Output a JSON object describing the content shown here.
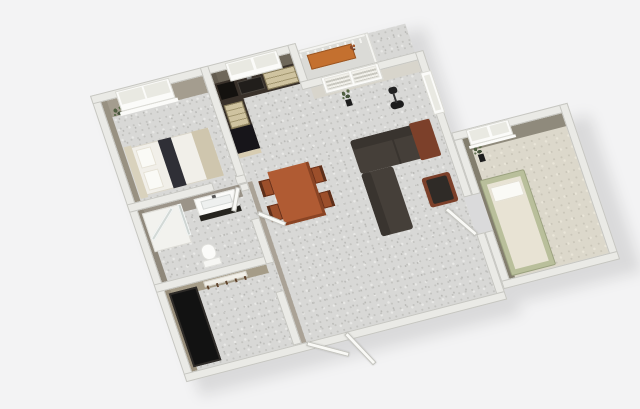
{
  "scene": {
    "title": "3D apartment floor plan render",
    "background": "#f3f3f4",
    "plan_matrix": "matrix(0.93,-0.24,0.31,0.92,90,96)",
    "shadow_matrix": "matrix(0.93,-0.24,0.31,0.92,104,110)",
    "shadow_color": "rgba(0,0,0,0.10)"
  },
  "palette": {
    "wall": "#eaeae6",
    "floor": "#d8d8d6",
    "bed1Wall": "#a49d8f",
    "bed1WallDk": "#989182",
    "kitchenWall": "#6e675a",
    "kitchenWallDk": "#645d51",
    "livingWall": "#d8d5cc",
    "bathWall": "#9b9489",
    "bathWallDk": "#8f887b",
    "entryWall": "#a59c88",
    "entryWallDk": "#998f7c",
    "bed2Wall": "#8f8a7c",
    "bed2WallDk": "#837e6e",
    "corridorWall": "#aaa296",
    "counterTop": "#39312a",
    "applianceBlack": "#17151a",
    "cooktop": "#14120f",
    "woodCab": "#cfc3a0",
    "cabEnd": "#d8cdb2",
    "sinkDark": "#211e1b",
    "metal": "#8a8a88",
    "sofa": "#453f39",
    "sofaDark": "#39342f",
    "rust": "#7c402a",
    "chairWood": "#9c4f2b",
    "chairDark": "#5d2f1a",
    "table": "#b05b33",
    "tableEdge": "#8a4424",
    "bedSheet": "#f1efe9",
    "headboard": "#d9d2bd",
    "pillow": "#fafaf6",
    "runner": "#2f2f36",
    "footBlanket": "#cfc6ae",
    "white": "#fbfbf9",
    "paneGlass": "#e9e9e2",
    "vanityBase": "#26241f",
    "wardrobe": "#121212",
    "bed2Frame": "#b9bf9b",
    "mattress": "#e8e3d4",
    "bench": "#c4702f",
    "lamp": "#1c1c1c",
    "pot": "#1d1d1d"
  },
  "rooms": [
    "bedroom-1",
    "kitchen",
    "living-room",
    "dining-area",
    "bathroom",
    "entry-hall",
    "bedroom-2",
    "balcony"
  ],
  "elements": [
    {
      "layer": "shadow",
      "name": "building-shadow-main",
      "x": 0,
      "y": 0,
      "w": 345,
      "h": 311,
      "fill": "rgba(0,0,0,0.10)"
    },
    {
      "layer": "shadow",
      "name": "building-shadow-bedroom2",
      "x": 345,
      "y": 130,
      "w": 134,
      "h": 170,
      "fill": "rgba(0,0,0,0.10)"
    },
    {
      "name": "main-floor",
      "x": 9,
      "y": 9,
      "w": 327,
      "h": 293,
      "cls": "floor-speckle"
    },
    {
      "name": "bedroom2-floor",
      "x": 354,
      "y": 139,
      "w": 107,
      "h": 152,
      "cls": "floor-beige"
    },
    {
      "name": "balcony-floor",
      "x": 221,
      "y": 10,
      "w": 75,
      "h": 30,
      "fill": "#dbdbd7"
    },
    {
      "name": "bedroom1-wall-face-top",
      "x": 9,
      "y": 9,
      "w": 109,
      "h": 18,
      "fill": "bed1Wall"
    },
    {
      "name": "bedroom1-wall-face-left",
      "x": 9,
      "y": 9,
      "w": 6,
      "h": 109,
      "fill": "bed1WallDk"
    },
    {
      "name": "kitchen-wall-face-top",
      "x": 127,
      "y": 9,
      "w": 85,
      "h": 20,
      "fill": "kitchenWall"
    },
    {
      "name": "kitchen-wall-face-left",
      "x": 127,
      "y": 9,
      "w": 5,
      "h": 89,
      "fill": "kitchenWallDk"
    },
    {
      "name": "living-wall-face-top",
      "x": 221,
      "y": 49,
      "w": 115,
      "h": 12,
      "fill": "livingWall"
    },
    {
      "name": "bathroom-wall-face-top",
      "x": 9,
      "y": 127,
      "w": 109,
      "h": 13,
      "fill": "bathWall"
    },
    {
      "name": "bathroom-wall-face-left",
      "x": 9,
      "y": 127,
      "w": 6,
      "h": 78,
      "fill": "bathWallDk"
    },
    {
      "name": "entry-wall-face-top",
      "x": 9,
      "y": 214,
      "w": 109,
      "h": 9,
      "fill": "entryWall"
    },
    {
      "name": "entry-wall-face-left",
      "x": 9,
      "y": 214,
      "w": 6,
      "h": 88,
      "fill": "entryWallDk"
    },
    {
      "name": "corridor-wall-face",
      "x": 127,
      "y": 127,
      "w": 5,
      "h": 175,
      "fill": "corridorWall"
    },
    {
      "name": "bedroom2-wall-face-top",
      "x": 354,
      "y": 139,
      "w": 107,
      "h": 14,
      "fill": "bed2Wall"
    },
    {
      "name": "bedroom2-wall-face-left",
      "x": 354,
      "y": 139,
      "w": 6,
      "h": 152,
      "fill": "bed2WallDk"
    },
    {
      "name": "bed-double-base",
      "x": 20,
      "y": 62,
      "w": 86,
      "h": 52,
      "fill": "bedSheet",
      "border": "1px solid #d8d4c8"
    },
    {
      "name": "bed-double-headboard",
      "x": 16,
      "y": 60,
      "w": 8,
      "h": 56,
      "fill": "headboard"
    },
    {
      "name": "bed-double-pillow-top",
      "x": 27,
      "y": 66,
      "w": 16,
      "h": 20,
      "fill": "pillow",
      "border": "1px solid #e5e1d5"
    },
    {
      "name": "bed-double-pillow-bottom",
      "x": 27,
      "y": 90,
      "w": 16,
      "h": 20,
      "fill": "pillow",
      "border": "1px solid #e5e1d5"
    },
    {
      "name": "bed-double-runner",
      "x": 52,
      "y": 62,
      "w": 14,
      "h": 52,
      "fill": "runner"
    },
    {
      "name": "bed-double-foot-blanket",
      "x": 88,
      "y": 62,
      "w": 18,
      "h": 52,
      "fill": "footBlanket"
    },
    {
      "name": "bedroom1-plant",
      "x": 14,
      "y": 14,
      "w": 18,
      "h": 16,
      "cls": "plant"
    },
    {
      "name": "kitchen-counter-top-leg",
      "x": 127,
      "y": 20,
      "w": 85,
      "h": 22,
      "fill": "counterTop"
    },
    {
      "name": "kitchen-counter-left-leg",
      "x": 127,
      "y": 20,
      "w": 24,
      "h": 76,
      "fill": "counterTop"
    },
    {
      "name": "kitchen-cooktop",
      "x": 129,
      "y": 22,
      "w": 18,
      "h": 16,
      "fill": "cooktop"
    },
    {
      "name": "kitchen-sink",
      "x": 150,
      "y": 24,
      "w": 26,
      "h": 14,
      "fill": "sinkDark",
      "border": "1px solid #4a453e"
    },
    {
      "name": "kitchen-faucet",
      "x": 161,
      "y": 21,
      "w": 5,
      "h": 3,
      "fill": "metal"
    },
    {
      "name": "kitchen-drawer-unit",
      "x": 178,
      "y": 22,
      "w": 34,
      "h": 18,
      "cls": "drawers"
    },
    {
      "name": "kitchen-lower-cabinet",
      "x": 129,
      "y": 44,
      "w": 20,
      "h": 26,
      "cls": "drawers"
    },
    {
      "name": "kitchen-fridge",
      "x": 127,
      "y": 70,
      "w": 24,
      "h": 26,
      "fill": "applianceBlack"
    },
    {
      "name": "kitchen-cabinet-end-panel",
      "x": 127,
      "y": 96,
      "w": 24,
      "h": 5,
      "fill": "cabEnd"
    },
    {
      "name": "shower-tray",
      "x": 12,
      "y": 131,
      "w": 40,
      "h": 42,
      "fill": "#f2f2ee",
      "border": "1px solid #dddcd6"
    },
    {
      "name": "shower-glass-diagonal",
      "x": 14,
      "y": 158,
      "w": 40,
      "h": 4,
      "cls": "glass",
      "rot": -42
    },
    {
      "name": "shower-glass-side",
      "x": 50,
      "y": 131,
      "w": 4,
      "h": 34,
      "cls": "glass"
    },
    {
      "name": "vanity-top",
      "x": 68,
      "y": 130,
      "w": 44,
      "h": 20,
      "fill": "white",
      "border": "1px solid #e2e2de"
    },
    {
      "name": "vanity-basin",
      "x": 74,
      "y": 134,
      "w": 32,
      "h": 9,
      "fill": "#eef0ef",
      "border": "1px solid #d5d8d6"
    },
    {
      "name": "vanity-faucet",
      "x": 87,
      "y": 131,
      "w": 4,
      "h": 3,
      "fill": "#555555"
    },
    {
      "name": "vanity-base",
      "x": 68,
      "y": 148,
      "w": 44,
      "h": 6,
      "fill": "vanityBase"
    },
    {
      "name": "toilet-bowl",
      "x": 58,
      "y": 178,
      "w": 15,
      "h": 17,
      "fill": "white",
      "border": "1px solid #dfdfdb",
      "r": 7
    },
    {
      "name": "toilet-tank",
      "x": 56,
      "y": 194,
      "w": 19,
      "h": 8,
      "fill": "#f6f6f3",
      "border": "1px solid #dfdfdb"
    },
    {
      "name": "entry-wardrobe",
      "x": 12,
      "y": 218,
      "w": 30,
      "h": 80,
      "fill": "wardrobe",
      "cls": "inset"
    },
    {
      "name": "coat-rack-board",
      "x": 50,
      "y": 215,
      "w": 46,
      "h": 6,
      "fill": "#f1efe8",
      "border": "1px solid #d8d5cc"
    },
    {
      "name": "coat-rack-hooks",
      "x": 52,
      "y": 220,
      "w": 42,
      "h": 4,
      "cls": "hooks"
    },
    {
      "name": "dining-table",
      "x": 150,
      "y": 122,
      "w": 44,
      "h": 58,
      "fill": "table"
    },
    {
      "name": "dining-table-edge-right",
      "x": 191,
      "y": 122,
      "w": 3,
      "h": 58,
      "fill": "tableEdge"
    },
    {
      "name": "dining-table-edge-bottom",
      "x": 150,
      "y": 177,
      "w": 44,
      "h": 3,
      "fill": "tableEdge"
    },
    {
      "name": "dining-chair-left-1",
      "x": 138,
      "y": 129,
      "w": 12,
      "h": 17,
      "fill": "chairWood",
      "border": "1px solid #6b3018"
    },
    {
      "name": "dining-chair-left-2",
      "x": 138,
      "y": 156,
      "w": 12,
      "h": 17,
      "fill": "chairWood",
      "border": "1px solid #6b3018"
    },
    {
      "name": "dining-chair-right-1",
      "x": 194,
      "y": 129,
      "w": 12,
      "h": 17,
      "fill": "chairWood",
      "border": "1px solid #6b3018"
    },
    {
      "name": "dining-chair-right-2",
      "x": 194,
      "y": 156,
      "w": 12,
      "h": 17,
      "fill": "chairWood",
      "border": "1px solid #6b3018"
    },
    {
      "name": "dining-chair-back-l1",
      "x": 138,
      "y": 129,
      "w": 3,
      "h": 17,
      "fill": "chairDark"
    },
    {
      "name": "dining-chair-back-l2",
      "x": 138,
      "y": 156,
      "w": 3,
      "h": 17,
      "fill": "chairDark"
    },
    {
      "name": "dining-chair-back-r1",
      "x": 203,
      "y": 129,
      "w": 3,
      "h": 17,
      "fill": "chairDark"
    },
    {
      "name": "dining-chair-back-r2",
      "x": 203,
      "y": 156,
      "w": 3,
      "h": 17,
      "fill": "chairDark"
    },
    {
      "name": "sofa-chaise-section",
      "x": 242,
      "y": 112,
      "w": 84,
      "h": 36,
      "fill": "sofa",
      "r": 3
    },
    {
      "name": "sofa-back-top",
      "x": 242,
      "y": 112,
      "w": 84,
      "h": 10,
      "fill": "sofaDark",
      "r": 3
    },
    {
      "name": "sofa-seat-seam",
      "x": 284,
      "y": 122,
      "w": 2,
      "h": 26,
      "fill": "sofaDark"
    },
    {
      "name": "sofa-throw-blanket",
      "x": 306,
      "y": 110,
      "w": 22,
      "h": 40,
      "fill": "rust",
      "r": 2
    },
    {
      "name": "sofa-long-section",
      "x": 242,
      "y": 148,
      "w": 34,
      "h": 68,
      "fill": "sofa",
      "r": 3
    },
    {
      "name": "sofa-back-left",
      "x": 242,
      "y": 148,
      "w": 10,
      "h": 68,
      "fill": "sofaDark",
      "r": 3
    },
    {
      "name": "armchair",
      "x": 300,
      "y": 168,
      "w": 30,
      "h": 32,
      "fill": "rust",
      "r": 3
    },
    {
      "name": "armchair-cushion",
      "x": 304,
      "y": 171,
      "w": 22,
      "h": 26,
      "fill": "#2f2b27",
      "r": 2
    },
    {
      "name": "floor-lamp-base",
      "x": 294,
      "y": 84,
      "w": 14,
      "h": 8,
      "fill": "lamp",
      "r": 7
    },
    {
      "name": "floor-lamp-stem",
      "x": 300,
      "y": 76,
      "w": 2,
      "h": 10,
      "fill": "#333333"
    },
    {
      "name": "floor-lamp-shade",
      "x": 297,
      "y": 69,
      "w": 9,
      "h": 7,
      "fill": "#222222",
      "r": 3
    },
    {
      "name": "living-plant",
      "x": 246,
      "y": 56,
      "w": 16,
      "h": 16,
      "cls": "plant"
    },
    {
      "name": "living-plant-pot",
      "x": 251,
      "y": 70,
      "w": 6,
      "h": 7,
      "fill": "pot"
    },
    {
      "name": "bedroom2-plant",
      "x": 358,
      "y": 146,
      "w": 16,
      "h": 15,
      "cls": "plant"
    },
    {
      "name": "bedroom2-plant-pot",
      "x": 364,
      "y": 159,
      "w": 6,
      "h": 8,
      "fill": "pot"
    },
    {
      "name": "bed-single-frame",
      "x": 357,
      "y": 185,
      "w": 48,
      "h": 104,
      "fill": "bed2Frame",
      "border": "1px solid #9aa17e",
      "r": 2
    },
    {
      "name": "bed-single-mattress",
      "x": 363,
      "y": 191,
      "w": 36,
      "h": 92,
      "fill": "mattress"
    },
    {
      "name": "bed-single-pillow",
      "x": 365,
      "y": 195,
      "w": 32,
      "h": 16,
      "fill": "pillow",
      "border": "1px solid #e3dfd2"
    },
    {
      "name": "balcony-rail-top",
      "x": 221,
      "y": 8,
      "w": 75,
      "h": 4,
      "fill": "#f4f4f1",
      "border": "1px solid #d9d9d4"
    },
    {
      "name": "balcony-rail-posts",
      "x": 221,
      "y": 12,
      "w": 75,
      "h": 5,
      "cls": "posts"
    },
    {
      "name": "balcony-rail-right",
      "x": 292,
      "y": 8,
      "w": 4,
      "h": 34,
      "fill": "#f4f4f1",
      "border": "1px solid #d9d9d4"
    },
    {
      "name": "balcony-bench",
      "x": 228,
      "y": 15,
      "w": 48,
      "h": 16,
      "fill": "bench",
      "border": "1px solid #9a5522"
    },
    {
      "name": "balcony-plant",
      "x": 270,
      "y": 13,
      "w": 12,
      "h": 12,
      "cls": "plant-red"
    },
    {
      "name": "wall-outer-left",
      "x": 0,
      "y": 0,
      "w": 9,
      "h": 311,
      "cls": "wall"
    },
    {
      "name": "wall-outer-top",
      "x": 0,
      "y": 0,
      "w": 221,
      "h": 9,
      "cls": "wall"
    },
    {
      "name": "wall-kitchen-right",
      "x": 212,
      "y": 0,
      "w": 9,
      "h": 49,
      "cls": "wall"
    },
    {
      "name": "wall-living-top",
      "x": 212,
      "y": 40,
      "w": 133,
      "h": 9,
      "cls": "wall"
    },
    {
      "name": "wall-living-right-upper",
      "x": 336,
      "y": 40,
      "w": 9,
      "h": 158,
      "cls": "wall"
    },
    {
      "name": "wall-living-right-lower",
      "x": 336,
      "y": 238,
      "w": 9,
      "h": 72,
      "cls": "wall"
    },
    {
      "name": "wall-outer-bottom",
      "x": 0,
      "y": 302,
      "w": 345,
      "h": 9,
      "cls": "wall"
    },
    {
      "name": "wall-bedroom2-left-upper",
      "x": 345,
      "y": 130,
      "w": 9,
      "h": 68,
      "cls": "wall"
    },
    {
      "name": "wall-bedroom2-left-lower",
      "x": 345,
      "y": 238,
      "w": 9,
      "h": 62,
      "cls": "wall"
    },
    {
      "name": "wall-bedroom2-top",
      "x": 345,
      "y": 130,
      "w": 125,
      "h": 9,
      "cls": "wall"
    },
    {
      "name": "wall-bedroom2-right",
      "x": 461,
      "y": 130,
      "w": 9,
      "h": 170,
      "cls": "wall"
    },
    {
      "name": "wall-bedroom2-bottom",
      "x": 345,
      "y": 291,
      "w": 125,
      "h": 9,
      "cls": "wall"
    },
    {
      "name": "wall-bedroom1-kitchen",
      "x": 118,
      "y": 0,
      "w": 9,
      "h": 127,
      "cls": "wall"
    },
    {
      "name": "wall-bedroom1-bottom-a",
      "x": 0,
      "y": 118,
      "w": 92,
      "h": 9,
      "cls": "wall"
    },
    {
      "name": "wall-bedroom1-bottom-b",
      "x": 116,
      "y": 118,
      "w": 11,
      "h": 9,
      "cls": "wall"
    },
    {
      "name": "wall-bathroom-bottom",
      "x": 0,
      "y": 205,
      "w": 127,
      "h": 9,
      "cls": "wall"
    },
    {
      "name": "wall-bathroom-right-a",
      "x": 118,
      "y": 127,
      "w": 9,
      "h": 8,
      "cls": "wall"
    },
    {
      "name": "wall-bathroom-right-b",
      "x": 118,
      "y": 165,
      "w": 9,
      "h": 49,
      "cls": "wall"
    },
    {
      "name": "wall-entry-right",
      "x": 118,
      "y": 244,
      "w": 9,
      "h": 58,
      "cls": "wall"
    },
    {
      "name": "bedroom1-window-frame",
      "x": 26,
      "y": 2,
      "w": 58,
      "h": 22,
      "fill": "white",
      "border": "1px solid #d9d9d3"
    },
    {
      "name": "bedroom1-window-pane-left",
      "x": 29,
      "y": 4,
      "w": 25,
      "h": 13,
      "fill": "paneGlass"
    },
    {
      "name": "bedroom1-window-pane-right",
      "x": 56,
      "y": 4,
      "w": 25,
      "h": 13,
      "fill": "paneGlass"
    },
    {
      "name": "bedroom1-window-sill",
      "x": 24,
      "y": 24,
      "w": 62,
      "h": 4,
      "fill": "white"
    },
    {
      "name": "kitchen-window-frame",
      "x": 144,
      "y": 2,
      "w": 56,
      "h": 20,
      "fill": "white",
      "border": "1px solid #d9d9d3"
    },
    {
      "name": "kitchen-window-pane-left",
      "x": 147,
      "y": 4,
      "w": 24,
      "h": 12,
      "fill": "paneGlass"
    },
    {
      "name": "kitchen-window-pane-right",
      "x": 174,
      "y": 4,
      "w": 23,
      "h": 12,
      "fill": "paneGlass"
    },
    {
      "name": "french-door-frame",
      "x": 234,
      "y": 41,
      "w": 62,
      "h": 18,
      "fill": "white",
      "border": "1px solid #d9d9d3"
    },
    {
      "name": "french-door-pane-left",
      "x": 237,
      "y": 43,
      "w": 27,
      "h": 13,
      "cls": "louver"
    },
    {
      "name": "french-door-pane-right",
      "x": 266,
      "y": 43,
      "w": 27,
      "h": 13,
      "cls": "louver"
    },
    {
      "name": "living-window-frame",
      "x": 334,
      "y": 62,
      "w": 12,
      "h": 46,
      "fill": "white",
      "border": "1px solid #d9d9d3"
    },
    {
      "name": "living-window-pane",
      "x": 337,
      "y": 66,
      "w": 6,
      "h": 38,
      "fill": "paneGlass"
    },
    {
      "name": "bedroom2-window-frame",
      "x": 360,
      "y": 131,
      "w": 46,
      "h": 17,
      "fill": "white",
      "border": "1px solid #d9d9d3"
    },
    {
      "name": "bedroom2-window-pane-left",
      "x": 363,
      "y": 133,
      "w": 19,
      "h": 11,
      "fill": "paneGlass"
    },
    {
      "name": "bedroom2-window-pane-right",
      "x": 385,
      "y": 133,
      "w": 18,
      "h": 11,
      "fill": "paneGlass"
    },
    {
      "name": "bedroom2-window-sill",
      "x": 358,
      "y": 148,
      "w": 50,
      "h": 3,
      "fill": "white"
    },
    {
      "name": "front-door-panel-a",
      "x": 132,
      "y": 301,
      "w": 44,
      "h": 5,
      "cls": "door",
      "rot": 30
    },
    {
      "name": "front-door-panel-b",
      "x": 174,
      "y": 301,
      "w": 42,
      "h": 5,
      "cls": "door",
      "rot": 64
    },
    {
      "name": "bathroom-door",
      "x": 127,
      "y": 158,
      "w": 30,
      "h": 5,
      "cls": "door",
      "rot": 38
    },
    {
      "name": "bedroom1-door",
      "x": 116,
      "y": 127,
      "w": 26,
      "h": 5,
      "cls": "door",
      "rot": 118
    },
    {
      "name": "bedroom2-door",
      "x": 336,
      "y": 236,
      "w": 40,
      "h": 5,
      "cls": "door",
      "rot": -122
    }
  ]
}
